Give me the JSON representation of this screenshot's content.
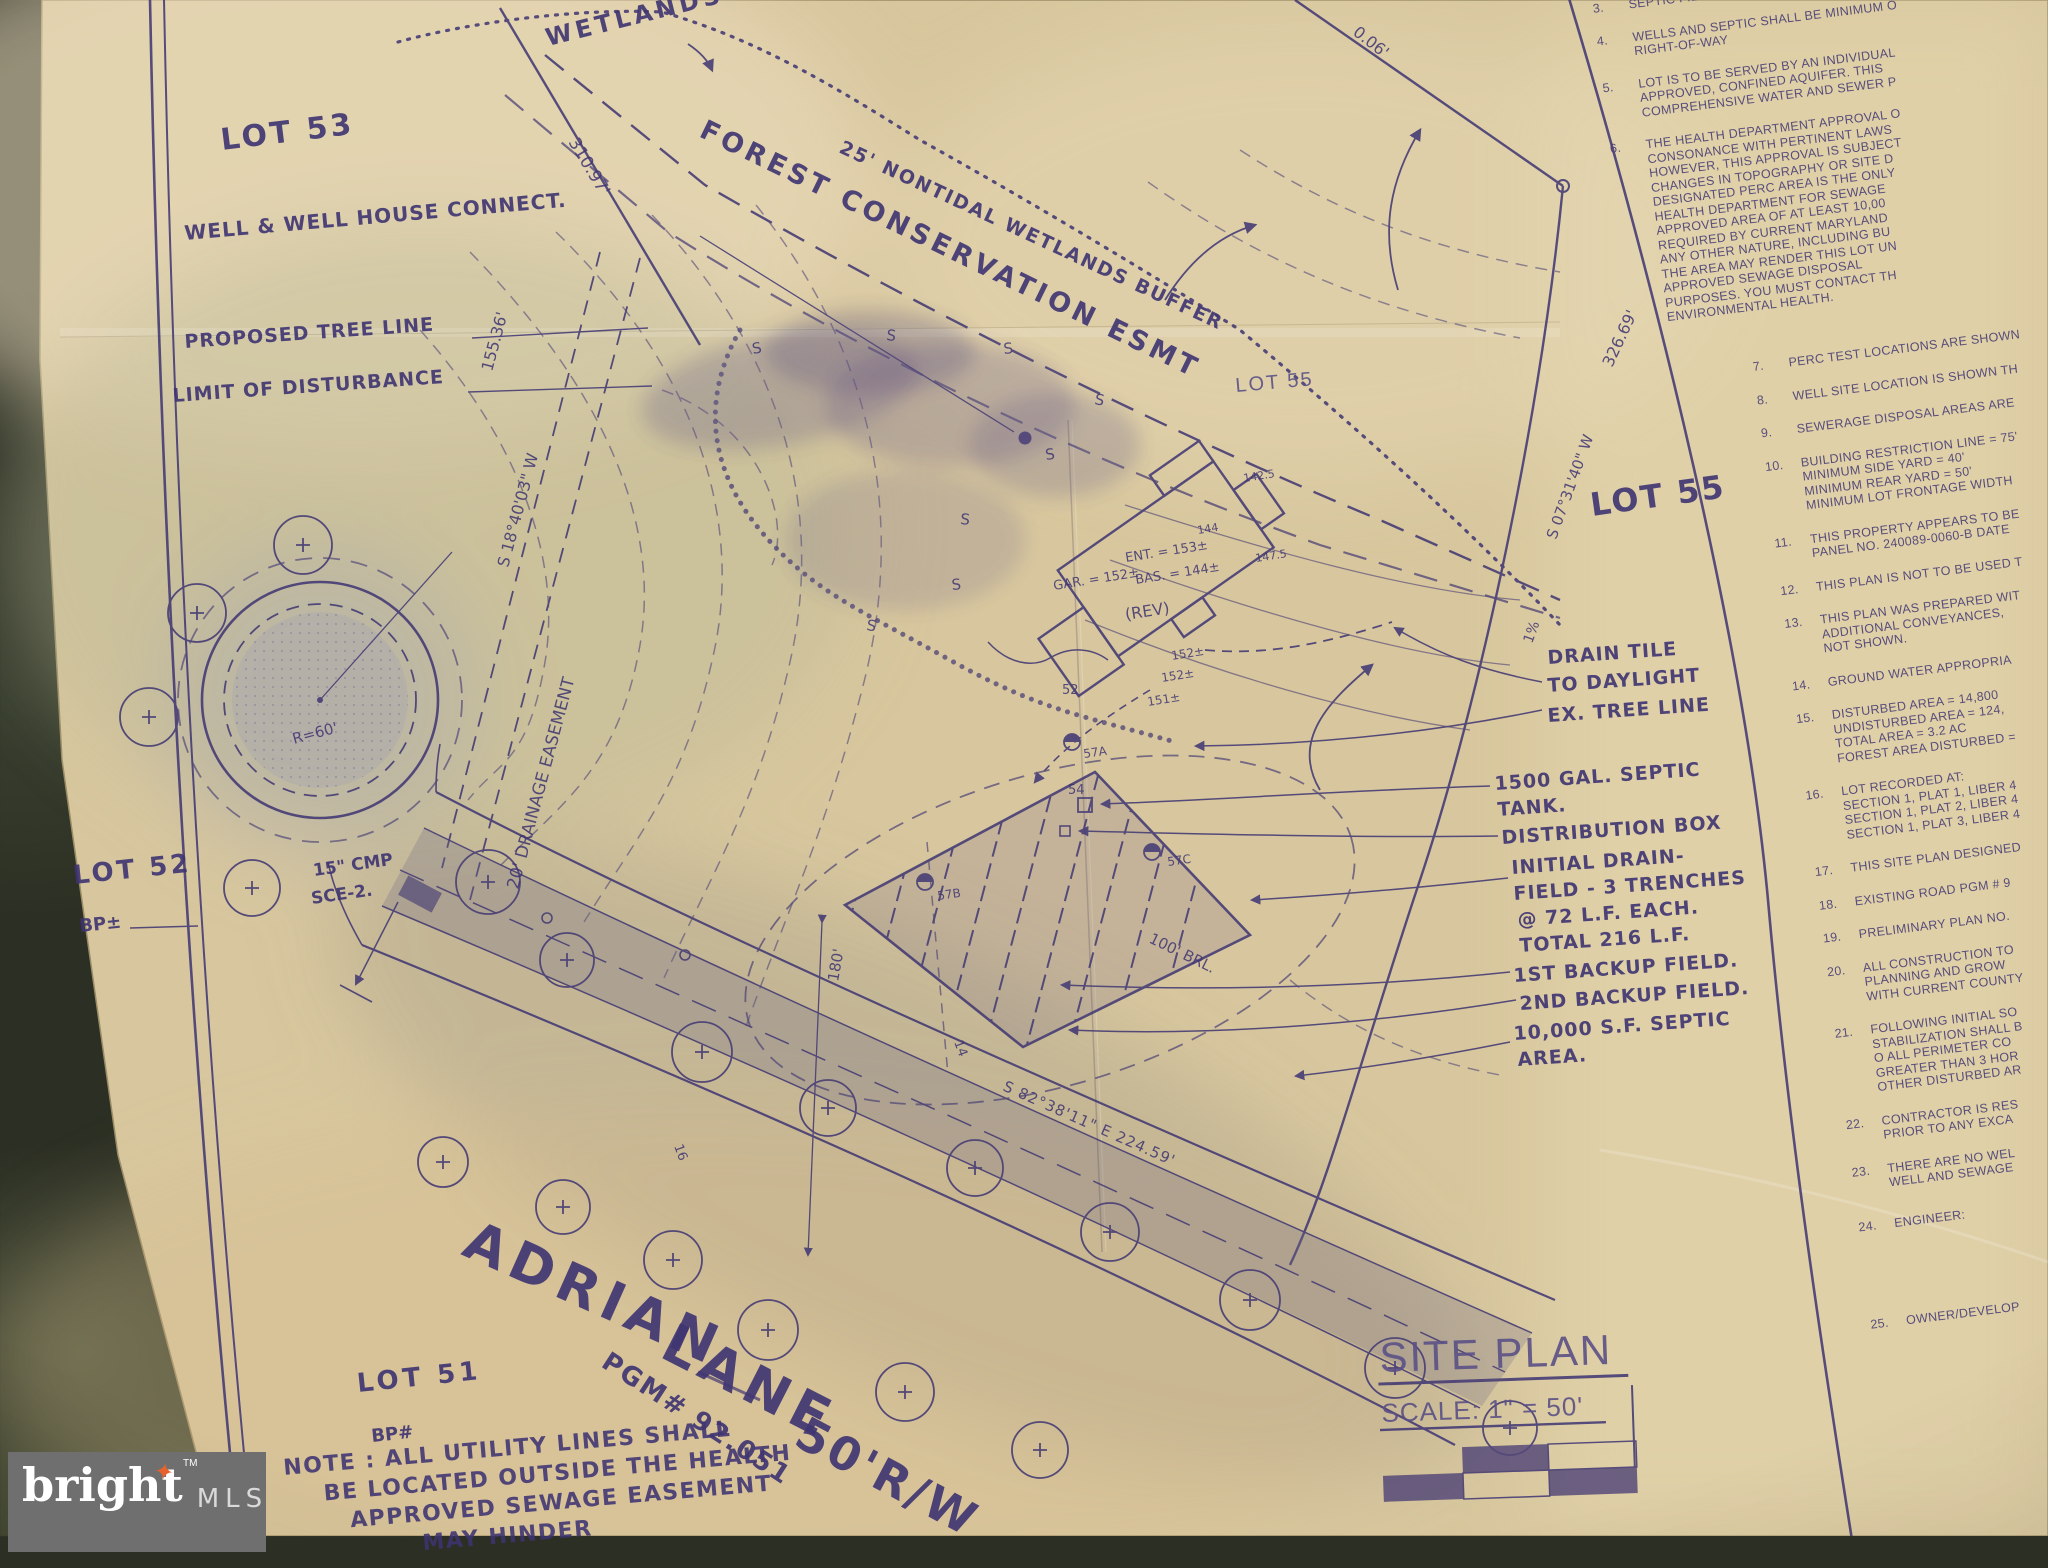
{
  "watermark": {
    "brand": "bright",
    "tm": "TM",
    "mls": "MLS"
  },
  "title_block": {
    "title": "SITE PLAN",
    "scale": "SCALE: 1\" = 50'"
  },
  "lots": {
    "lot53": "LOT 53",
    "lot55_small": "LOT 55",
    "lot55_large": "LOT 55",
    "lot52": "LOT 52",
    "lot52_bp": "BP±",
    "lot51": "LOT 51",
    "lot51_bp": "BP#"
  },
  "road_names": {
    "adrian": "ADRIAN",
    "lane": "LANE",
    "rw": "50'R/W",
    "pgm": "PGM# 92.051",
    "bearing": "S 82°38'11\" E   224.59'",
    "sta16": "16",
    "sta14": "14"
  },
  "west_labels": {
    "well_connect": "WELL & WELL HOUSE CONNECT.",
    "proposed_tree_line": "PROPOSED TREE LINE",
    "limit_of_disturbance": "LIMIT OF DISTURBANCE"
  },
  "wetlands": {
    "wetlands": "WETLANDS",
    "buffer": "25' NONTIDAL WETLANDS BUFFER",
    "forest_esmt": "FOREST CONSERVATION ESMT",
    "s_marker": "S"
  },
  "easements": {
    "drainage": "20' DRAINAGE EASEMENT",
    "cmp": "15\" CMP",
    "sce": "SCE-2.",
    "radius": "R=60'"
  },
  "bearings": {
    "d310": "310.97'",
    "d155": "155.36'",
    "s18": "S 18°40'03\" W",
    "s07": "S 07°31'40\" W",
    "d326": "326.69'",
    "frag": "0.06'",
    "grade": "1%",
    "c52": "52",
    "c54": "54"
  },
  "house": {
    "ent": "ENT. = 153±",
    "bas": "BAS. = 144±",
    "gar": "GAR. = 152±",
    "rev": "(REV)",
    "e152a": "152±",
    "e152b": "152±",
    "e151": "151±",
    "e144": "144",
    "e1475": "147.5",
    "e1425": "142.5"
  },
  "septic": {
    "drain_tile_1": "DRAIN TILE",
    "drain_tile_2": "TO DAYLIGHT",
    "ex_tree_line": "EX. TREE LINE",
    "tank_1": "1500 GAL. SEPTIC",
    "tank_2": "TANK.",
    "dist_box": "DISTRIBUTION BOX",
    "field_1": "INITIAL DRAIN-",
    "field_2": "FIELD - 3 TRENCHES",
    "field_3": "@ 72 L.F. EACH.",
    "field_4": "TOTAL 216 L.F.",
    "backup1": "1ST BACKUP FIELD.",
    "backup2": "2ND BACKUP FIELD.",
    "area_1": "10,000 S.F. SEPTIC",
    "area_2": "AREA.",
    "brl": "100' BRL.",
    "dim180": "180'",
    "p57a": "57A",
    "p57b": "57B",
    "p57c": "57C"
  },
  "bottom_note": {
    "l1": "NOTE : ALL UTILITY LINES SHALL",
    "l2": "BE LOCATED OUTSIDE THE HEALTH",
    "l3": "APPROVED SEWAGE EASEMENT",
    "l4": "MAY HINDER"
  },
  "notes": [
    {
      "num": "3.",
      "lines": [
        "SEPTIC FIELD SHALL BE MINIMUM 25"
      ]
    },
    {
      "num": "4.",
      "lines": [
        "WELLS AND SEPTIC SHALL BE MINIMUM O",
        "RIGHT-OF-WAY"
      ]
    },
    {
      "num": "5.",
      "lines": [
        "LOT IS TO BE SERVED BY AN INDIVIDUAL",
        "APPROVED, CONFINED AQUIFER. THIS",
        "COMPREHENSIVE WATER AND SEWER P"
      ]
    },
    {
      "num": "6.",
      "lines": [
        "THE HEALTH DEPARTMENT APPROVAL O",
        "CONSONANCE WITH PERTINENT LAWS",
        "HOWEVER, THIS APPROVAL IS SUBJECT",
        "CHANGES IN TOPOGRAPHY OR SITE D",
        "DESIGNATED PERC AREA IS THE ONLY",
        "HEALTH DEPARTMENT FOR SEWAGE",
        "APPROVED AREA OF AT LEAST 10,00",
        "REQUIRED BY CURRENT MARYLAND",
        "ANY OTHER NATURE, INCLUDING BU",
        "THE AREA MAY RENDER THIS LOT UN",
        "APPROVED SEWAGE DISPOSAL",
        "PURPOSES. YOU MUST CONTACT TH",
        "ENVIRONMENTAL HEALTH."
      ]
    },
    {
      "num": "7.",
      "lines": [
        "PERC TEST LOCATIONS ARE SHOWN"
      ]
    },
    {
      "num": "8.",
      "lines": [
        "WELL SITE LOCATION IS SHOWN TH"
      ]
    },
    {
      "num": "9.",
      "lines": [
        "SEWERAGE DISPOSAL AREAS ARE"
      ]
    },
    {
      "num": "10.",
      "lines": [
        "BUILDING RESTRICTION LINE = 75'",
        "MINIMUM SIDE YARD = 40'",
        "MINIMUM REAR YARD = 50'",
        "MINIMUM LOT FRONTAGE WIDTH"
      ]
    },
    {
      "num": "11.",
      "lines": [
        "THIS PROPERTY APPEARS TO BE",
        "PANEL NO. 240089-0060-B DATE"
      ]
    },
    {
      "num": "12.",
      "lines": [
        "THIS PLAN IS NOT TO BE USED T"
      ]
    },
    {
      "num": "13.",
      "lines": [
        "THIS PLAN WAS PREPARED WIT",
        "ADDITIONAL CONVEYANCES,",
        "NOT SHOWN."
      ]
    },
    {
      "num": "14.",
      "lines": [
        "GROUND WATER APPROPRIA"
      ]
    },
    {
      "num": "15.",
      "lines": [
        "DISTURBED AREA = 14,800",
        "UNDISTURBED AREA = 124,",
        "TOTAL AREA = 3.2 AC",
        "FOREST AREA DISTURBED ="
      ]
    },
    {
      "num": "16.",
      "lines": [
        "LOT RECORDED AT:",
        "SECTION 1, PLAT 1, LIBER 4",
        "SECTION 1, PLAT 2, LIBER 4",
        "SECTION 1, PLAT 3, LIBER 4"
      ]
    },
    {
      "num": "17.",
      "lines": [
        "THIS SITE PLAN DESIGNED"
      ]
    },
    {
      "num": "18.",
      "lines": [
        "EXISTING ROAD PGM # 9"
      ]
    },
    {
      "num": "19.",
      "lines": [
        "PRELIMINARY PLAN NO."
      ]
    },
    {
      "num": "20.",
      "lines": [
        "ALL CONSTRUCTION TO",
        "PLANNING AND GROW",
        "WITH CURRENT COUNTY"
      ]
    },
    {
      "num": "21.",
      "lines": [
        "FOLLOWING INITIAL SO",
        "STABILIZATION SHALL B",
        "O  ALL PERIMETER CO",
        "GREATER THAN 3 HOR",
        "OTHER DISTURBED AR"
      ]
    },
    {
      "num": "22.",
      "lines": [
        "CONTRACTOR IS RES",
        "PRIOR TO ANY EXCA"
      ]
    },
    {
      "num": "23.",
      "lines": [
        "THERE ARE NO WEL",
        "WELL AND SEWAGE"
      ]
    },
    {
      "num": "24.",
      "lines": [
        "ENGINEER:"
      ]
    },
    {
      "num": "25.",
      "lines": [
        "OWNER/DEVELOP"
      ]
    }
  ],
  "colors": {
    "ink": "#3e3472",
    "paper": "#d8c79e",
    "table": "#2c3024",
    "badge": "#6f6f6f",
    "star": "#e8632c"
  }
}
